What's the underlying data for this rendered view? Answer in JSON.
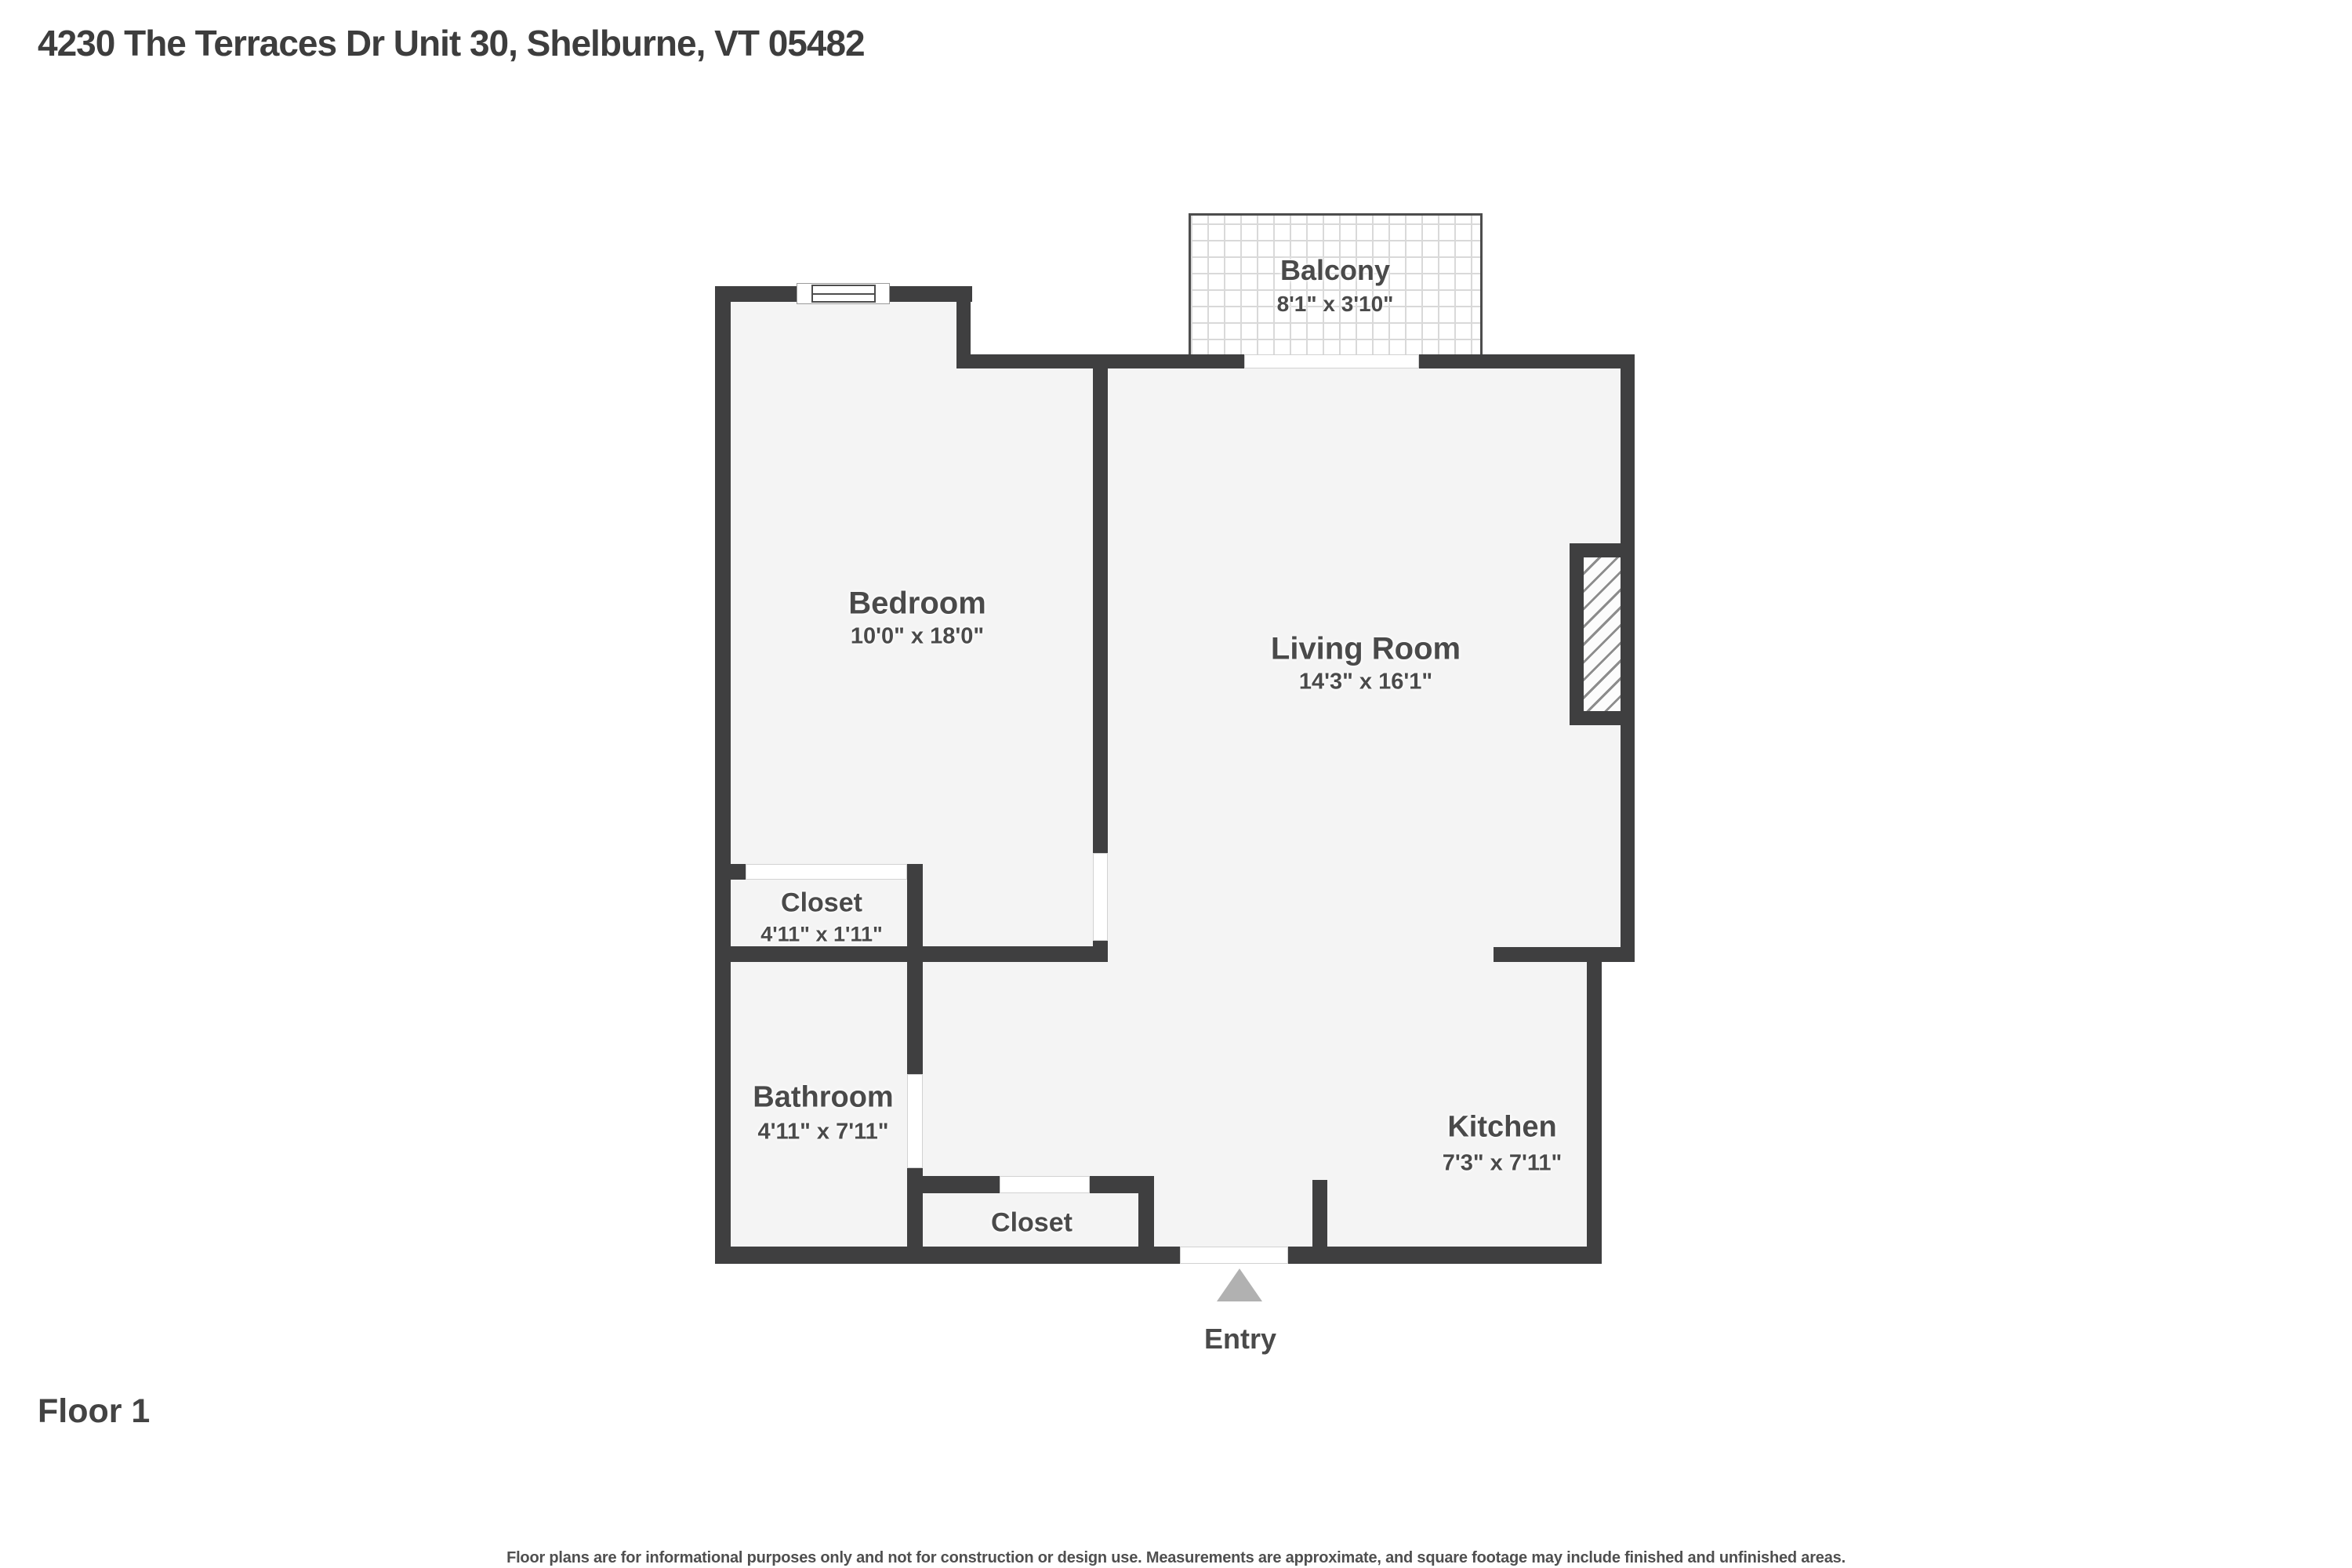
{
  "header": {
    "title": "4230 The Terraces Dr Unit 30, Shelburne, VT 05482"
  },
  "rooms": {
    "balcony": {
      "name": "Balcony",
      "dims": "8'1\" x 3'10\""
    },
    "bedroom": {
      "name": "Bedroom",
      "dims": "10'0\" x 18'0\""
    },
    "living_room": {
      "name": "Living Room",
      "dims": "14'3\" x 16'1\""
    },
    "bedroom_closet": {
      "name": "Closet",
      "dims": "4'11\" x 1'11\""
    },
    "bathroom": {
      "name": "Bathroom",
      "dims": "4'11\" x 7'11\""
    },
    "hall_closet": {
      "name": "Closet"
    },
    "kitchen": {
      "name": "Kitchen",
      "dims": "7'3\" x 7'11\""
    }
  },
  "entry": {
    "label": "Entry"
  },
  "footer": {
    "floor_label": "Floor 1",
    "disclaimer": "Floor plans are for informational purposes only and not for construction or design use. Measurements are approximate, and square footage may include finished and unfinished areas."
  },
  "colors": {
    "wall": "#3f3f40",
    "room_fill": "#f4f4f4",
    "label_text": "#4a4a4a",
    "door_opening": "#ffffff",
    "entry_arrow": "#b1b1b1",
    "page_background": "#ffffff"
  }
}
